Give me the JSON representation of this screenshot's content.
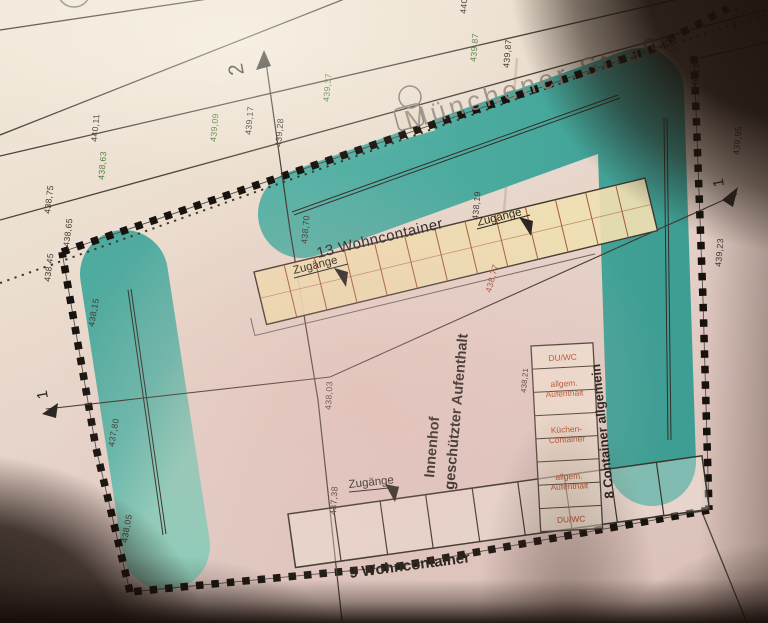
{
  "plan": {
    "street_name": "Münchener Straße",
    "row_top_label": "13 Wohncontainer",
    "row_bottom_label": "9 Wohncontainer",
    "column_label": "8 Container allgemein",
    "access_label": "Zugänge",
    "courtyard_line1": "Innenhof",
    "courtyard_line2": "geschützter Aufenthalt",
    "section_marker_1": "1",
    "section_marker_2": "2",
    "column_cells": [
      {
        "line1": "DU/WC",
        "line2": ""
      },
      {
        "line1": "allgem.",
        "line2": "Aufenthalt"
      },
      {
        "line1": "Küchen-",
        "line2": "Container"
      },
      {
        "line1": "allgem.",
        "line2": "Aufenthalt"
      },
      {
        "line1": "DU/WC",
        "line2": ""
      }
    ],
    "elevations": [
      {
        "value": "440,11",
        "color": "dark"
      },
      {
        "value": "438,63",
        "color": "green"
      },
      {
        "value": "438,75",
        "color": "dark"
      },
      {
        "value": "438,65",
        "color": "dark"
      },
      {
        "value": "438,45",
        "color": "dark"
      },
      {
        "value": "438,15",
        "color": "dark"
      },
      {
        "value": "437,80",
        "color": "dark"
      },
      {
        "value": "438,05",
        "color": "dark"
      },
      {
        "value": "439,09",
        "color": "green"
      },
      {
        "value": "439,17",
        "color": "dark"
      },
      {
        "value": "439,28",
        "color": "dark"
      },
      {
        "value": "439,37",
        "color": "green"
      },
      {
        "value": "438,70",
        "color": "dark"
      },
      {
        "value": "438,19",
        "color": "dark"
      },
      {
        "value": "438,77",
        "color": "red"
      },
      {
        "value": "438,03",
        "color": "dark"
      },
      {
        "value": "437,38",
        "color": "dark"
      },
      {
        "value": "438,21",
        "color": "dark"
      },
      {
        "value": "439,87",
        "color": "green"
      },
      {
        "value": "439,87",
        "color": "dark"
      },
      {
        "value": "440,12",
        "color": "dark"
      },
      {
        "value": "439,95",
        "color": "dark"
      },
      {
        "value": "439,23",
        "color": "dark"
      },
      {
        "value": "440",
        "color": "dark"
      },
      {
        "value": "440,4",
        "color": "dark"
      }
    ],
    "colors": {
      "hedge_teal": "#4fae9f",
      "boundary_black": "#17120e",
      "elevation_dark": "#3c362e",
      "elevation_green": "#4f7d3a",
      "elevation_red": "#a8503a",
      "container_fill": "#f0e0b2",
      "cell_text_orange": "#b5502a",
      "street_text_grey": "#8f8a80"
    }
  }
}
